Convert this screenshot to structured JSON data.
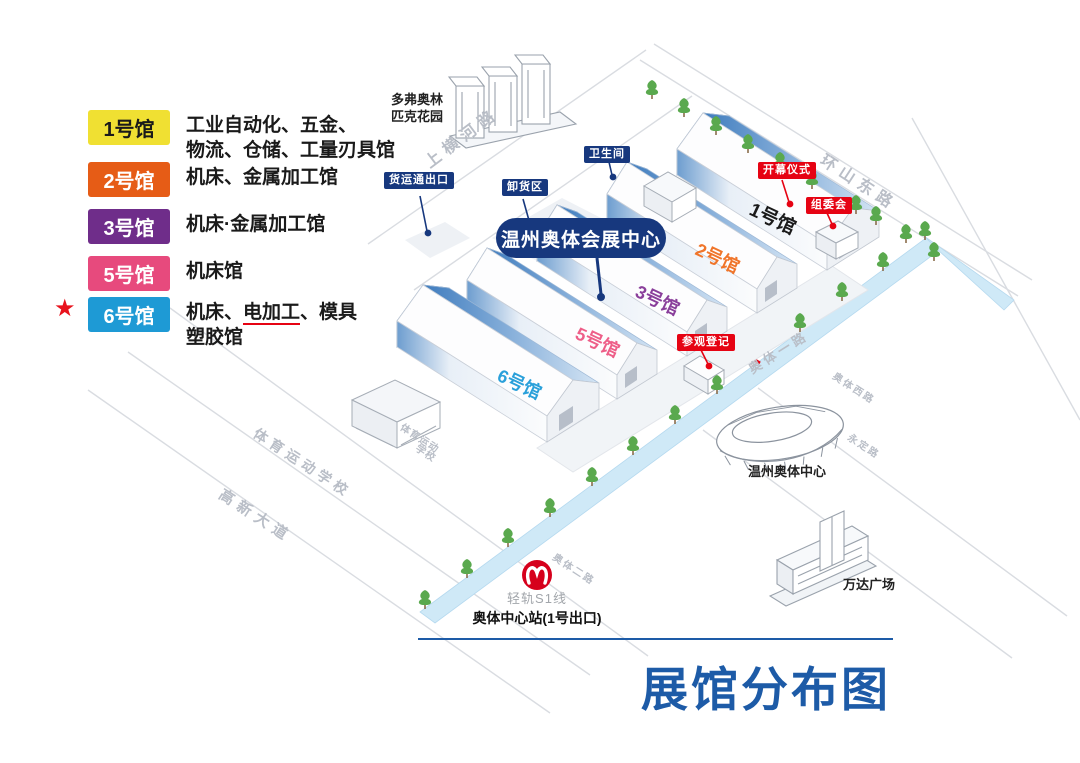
{
  "title": {
    "text": "展馆分布图",
    "color": "#1d5ba7"
  },
  "legend": {
    "star": "★",
    "items": [
      {
        "label": "1号馆",
        "badge_color": "#f0e032",
        "label_color": "#1a1a1a",
        "desc1": "工业自动化、五金、",
        "desc2": "物流、仓储、工量刃具馆",
        "starred": false
      },
      {
        "label": "2号馆",
        "badge_color": "#e65c16",
        "label_color": "#ffffff",
        "desc1": "机床、金属加工馆",
        "starred": false
      },
      {
        "label": "3号馆",
        "badge_color": "#6f2d8a",
        "label_color": "#ffffff",
        "desc1": "机床·金属加工馆",
        "starred": false
      },
      {
        "label": "5号馆",
        "badge_color": "#e74a7d",
        "label_color": "#ffffff",
        "desc1": "机床馆",
        "starred": false
      },
      {
        "label": "6号馆",
        "badge_color": "#1e9ad5",
        "label_color": "#ffffff",
        "desc_pre": "机床、",
        "desc_em": "电加工",
        "desc_mid": "、模具",
        "desc_line2": "塑胶馆",
        "starred": true
      }
    ]
  },
  "map": {
    "center_label": "温州奥体会展中心",
    "halls": [
      {
        "name": "1号馆",
        "color": "#1a1a1a"
      },
      {
        "name": "2号馆",
        "color": "#f0752a"
      },
      {
        "name": "3号馆",
        "color": "#8a3f9b"
      },
      {
        "name": "5号馆",
        "color": "#ee5e88"
      },
      {
        "name": "6号馆",
        "color": "#2aa0da"
      }
    ],
    "blue_tags": {
      "freight_exit": "货运通出口",
      "unloading": "卸货区",
      "restroom": "卫生间"
    },
    "red_tags": {
      "opening": "开幕仪式",
      "committee": "组委会",
      "registration": "参观登记"
    },
    "roads": {
      "shanghenghe": "上横河路",
      "huanshandong": "环山东路",
      "aoti1": "奥体一路",
      "aoti2": "奥体二路",
      "gaoxin": "高新大道",
      "aotixi": "奥体西路",
      "yongding": "永定路"
    },
    "areas": {
      "sports_school": "体育运动学校",
      "sports_school_l1": "体育运动",
      "sports_school_l2": "学校"
    },
    "places": {
      "dove_l1": "多弗奥林",
      "dove_l2": "匹克花园",
      "aoti_center": "温州奥体中心",
      "wanda": "万达广场"
    },
    "station": {
      "line": "轻轨S1线",
      "stop": "奥体中心站(1号出口)"
    }
  },
  "colors": {
    "navy": "#17387e",
    "badge_red": "#e60313",
    "title_blue": "#1d5ba7",
    "water": "#cfe9f7",
    "hall_slope_dark": "#3f7cbe",
    "hall_slope_light": "#d5e5f4",
    "road_gray": "#b9bec7",
    "tree_green": "#5aa94e"
  }
}
